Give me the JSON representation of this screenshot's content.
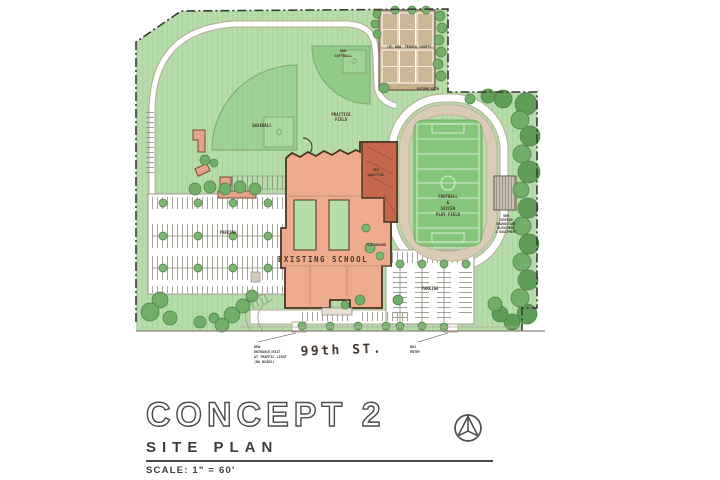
{
  "title_block": {
    "title": "CONCEPT 2",
    "subtitle": "SITE PLAN",
    "scale": "SCALE: 1\" = 60'"
  },
  "icons": {
    "north_arrow": "compass-north-arrow"
  },
  "colors": {
    "lawn": "#b7dcab",
    "field_green": "#93cc89",
    "infield_green": "#86c67c",
    "tree_dark": "#5f9d59",
    "tree_mid": "#72ae6a",
    "track_tan": "#d9cbb5",
    "court_tan": "#cdb698",
    "building_salmon": "#eeab8d",
    "addition_red": "#c4674a",
    "ink": "#4a3b30"
  },
  "labels": {
    "practice_field_1": "PRACTICE",
    "practice_field_2": "FIELD",
    "baseball": "BASEBALL",
    "softball_1": "NEW",
    "softball_2": "SOFTBALL",
    "tennis_1": "(6) NEW",
    "tennis_2": "TENNIS COURTS",
    "future_path": "FUTURE PATH",
    "football_1": "FOOTBALL",
    "football_2": "&",
    "football_3": "SOCCER",
    "football_4": "PLAY FIELD",
    "grandstand_1": "NEW",
    "grandstand_2": "COVERED",
    "grandstand_3": "GRANDSTAND",
    "grandstand_4": "BLEACHERS",
    "grandstand_5": "& EQUIPMENT",
    "addition_1": "NEW",
    "addition_2": "ADDITION",
    "school": "EXISTING SCHOOL",
    "playground": "PLAYGROUND",
    "parking_west": "PARKING",
    "parking_south": "PARKING",
    "street": "99th ST.",
    "entrance_1": "NEW",
    "entrance_2": "ENTRANCE/EXIT",
    "entrance_3": "AT TRAFFIC LIGHT",
    "entrance_4": "(NO BUSES)",
    "bus_1": "BUS",
    "bus_2": "ENTRY"
  }
}
